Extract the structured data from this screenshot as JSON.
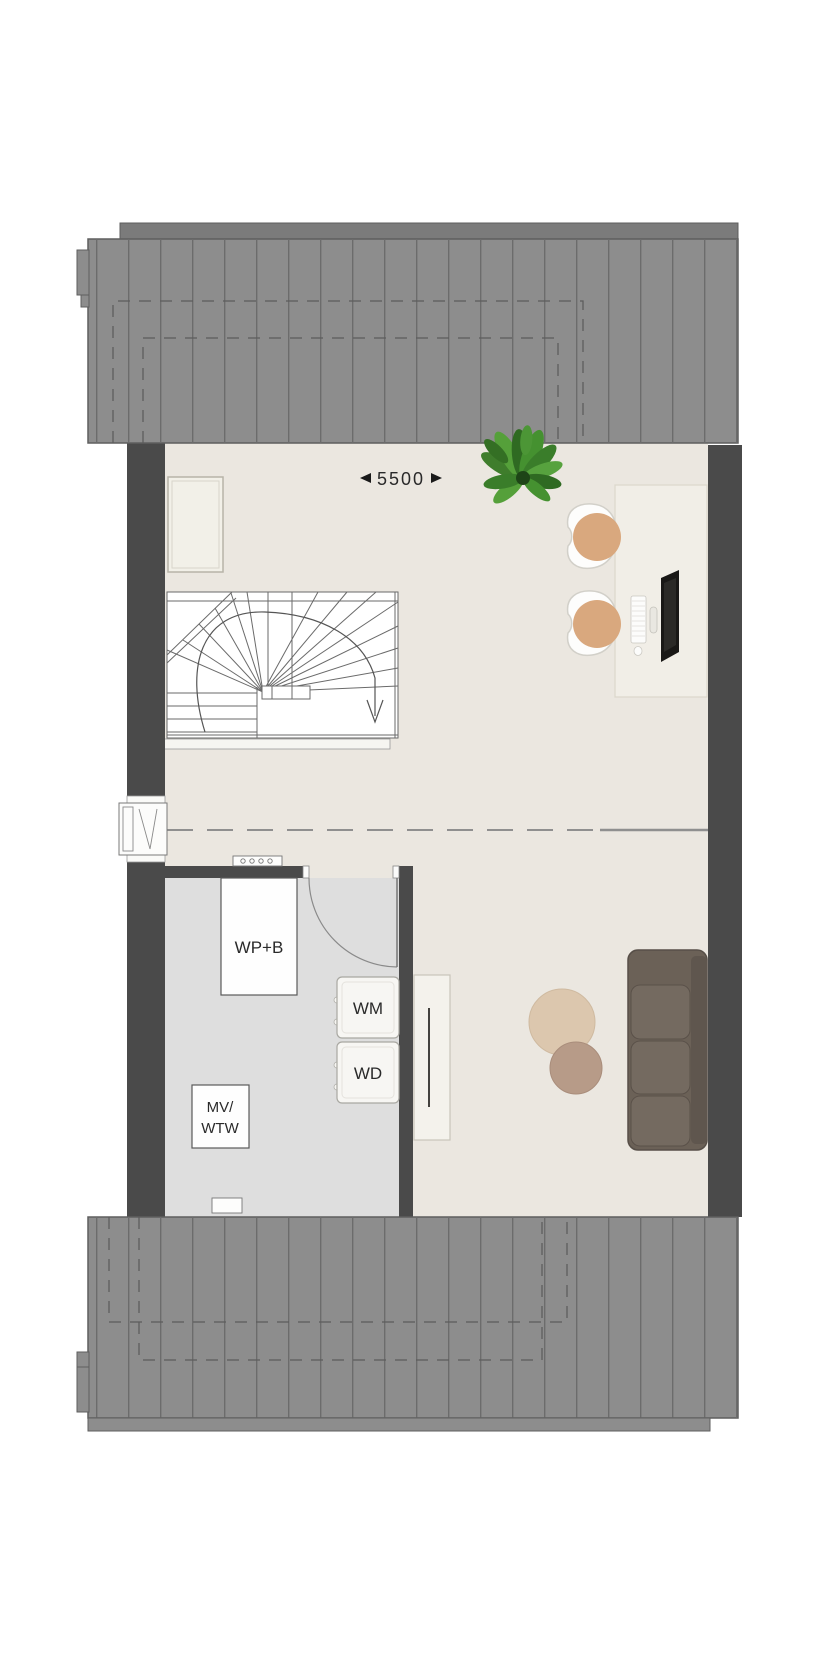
{
  "title": "attic-floor-plan",
  "dimension": {
    "width_label": "5500"
  },
  "technical_room": {
    "heat_pump_label": "WP+B",
    "washer_label": "WM",
    "dryer_label": "WD",
    "ventilation_label_line1": "MV/",
    "ventilation_label_line2": "WTW"
  },
  "colors": {
    "roof": "#8d8d8d",
    "roof_stripe": "#6c6c6c",
    "roof_band": "#7b7b7b",
    "wall": "#4a4a4a",
    "floor_main": "#ebe7e0",
    "floor_technical": "#dedede",
    "stair_line": "#6a6a6a",
    "sofa": "#6b6157",
    "sofa_cushion": "#746a60",
    "table_large": "#dcc7ae",
    "table_small": "#b79b88",
    "chair_cushion": "#d9a87e",
    "desk": "#f1eee7",
    "plant": "#4a8c33"
  }
}
